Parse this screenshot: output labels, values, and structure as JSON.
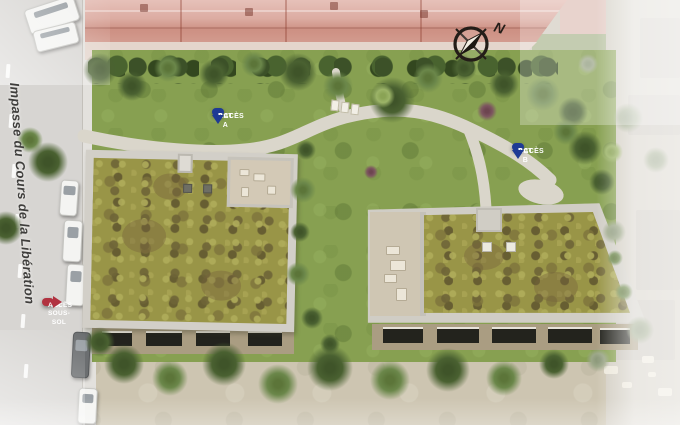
{
  "plan": {
    "street_name": "Impasse du Cours de la Libération",
    "compass_letter": "N",
    "pins": {
      "bat_a": {
        "line1": "ACCÈS",
        "line2": "BAT A"
      },
      "bat_b": {
        "line1": "ACCÈS",
        "line2": "BAT B"
      },
      "parking": {
        "line1": "ACCÈS",
        "line2": "P. SOUS-SOL"
      }
    }
  },
  "colors": {
    "pin_blue": "#1e3a94",
    "pin_red": "#b13240",
    "roof_vegetation": "#999547",
    "lawn_green": "#87a051",
    "path_gray": "#dad6cb",
    "roof_tiles_pink": "#d49e92",
    "pool_blue": "#5fa0cc"
  }
}
